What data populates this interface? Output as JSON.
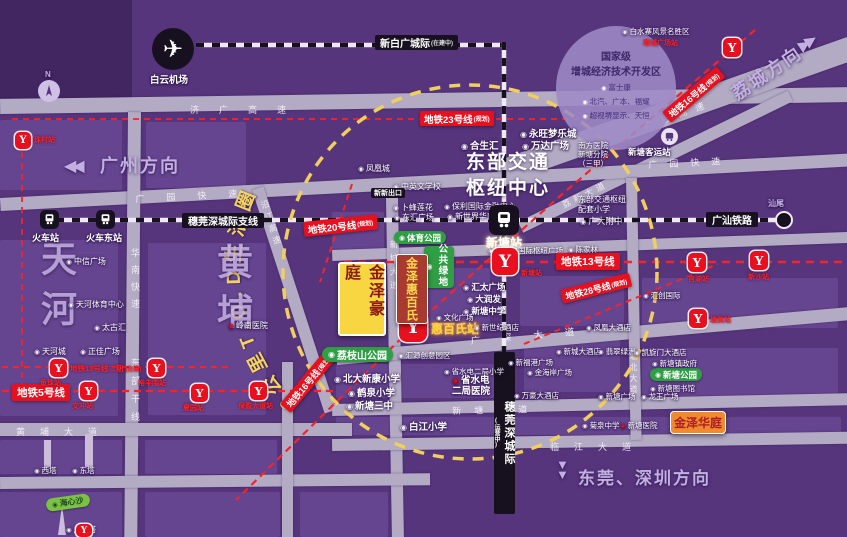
{
  "map_title": "金泽豪庭区位图",
  "circle_text": "3公里T.O.D生活圈",
  "directions": {
    "guangzhou": "广州方向",
    "licheng": "荔城方向",
    "dongguan_shenzhen": "东莞、深圳方向",
    "shanwei": "汕尾",
    "compass_n": "N"
  },
  "districts": {
    "tianhe": "天河",
    "huangpu": "黄埔"
  },
  "hub_title": "东部交通枢纽中心",
  "airport": "白云机场",
  "rails": {
    "xinbaiguang": {
      "t": "新白广城际",
      "s": "(在建中)"
    },
    "suiwanshen_branch": "穗莞深城际支线",
    "suiwanshen": {
      "t": "穗莞深城际",
      "s": "(运营中)"
    },
    "guangshan": "广汕铁路"
  },
  "train_stations": {
    "huochezhan": "火车站",
    "huochedongzhan": "火车东站",
    "xintangzhan": "新塘站",
    "keyunzhan": "新塘客运站"
  },
  "metro_lines": {
    "m5": {
      "t": "地铁5号线"
    },
    "m13": {
      "t": "地铁13号线"
    },
    "m13b": {
      "t": "地铁13号线二期",
      "s": "(在建)"
    },
    "m16": {
      "t": "地铁16号线",
      "s": "(规划)"
    },
    "m20": {
      "t": "地铁20号线",
      "s": "(规划)"
    },
    "m23": {
      "t": "地铁23号线",
      "s": "(规划)"
    },
    "m28": {
      "t": "地铁28号线",
      "s": "(规划)"
    }
  },
  "metro_stations": {
    "zhucun": "珠村站",
    "yuzhu": "鱼珠站",
    "yufengwei": "裕丰围站",
    "wenchong": "文冲站",
    "xiayuan": "夏园站",
    "baoying": "保盈大道站",
    "xintang": "新塘站",
    "guanhu": "官湖站",
    "xinsha": "新沙站",
    "tangmei": "塘美站",
    "zengchengguangchang": "增城广场站",
    "huibaishi": "惠百氏站"
  },
  "zone": {
    "t1": "国家级",
    "t2": "增城经济技术开发区",
    "items": [
      "富士康",
      "北汽、广本、福耀",
      "超视堺显示、天恒"
    ]
  },
  "projects": {
    "haoting": "金泽豪庭",
    "huibaishi": "金泽惠百氏",
    "huating": "金泽华庭"
  },
  "parks": {
    "tiyu": "体育公园",
    "lvdi": "公共绿地",
    "lizhishan": "荔枝山公园",
    "xintang": "新塘公园",
    "haixinsha": "海心沙"
  },
  "pois": {
    "zhongxin": "中信广场",
    "tianhetiyu": "天河体育中心",
    "taiguhui": "太古汇",
    "tianhecheng": "天河城",
    "zhengjia": "正佳广场",
    "lingnan": "岭南医院",
    "fenghuangcheng": "凤凰城",
    "zhongyingwen": "中英文学校",
    "bufeng": "卜蜂莲花",
    "donghui": "东汇广场",
    "baoli": "保利国际金融中心",
    "xinshijie": "新世界华南总部",
    "kaidaer": "凯达尔国际枢纽广场",
    "baishuizhai": "白水寨风景名胜区",
    "heshenghui": "合生汇",
    "yongwang": "永旺梦乐城",
    "wanda": "万达广场",
    "nanfang": "南方医院新塘分院（三甲）",
    "peitaoxiaoxue": "东部交通枢纽配套小学",
    "guangda": "广大附中",
    "chenjialin": "陈家林",
    "huitai": "汇太广场",
    "darunfa": "大润发",
    "xintangzhongxue": "新塘中学",
    "wenhua": "文化广场",
    "xinshiji": "新世纪酒店",
    "huichuang": "汇创国际",
    "fenghuanghotel": "凤凰大酒店",
    "feicui": "翡翠绿洲",
    "xinchenghotel": "新城大酒店",
    "kaixuanmen": "凯旋门大酒店",
    "xinfugang": "新福港广场",
    "jinhaian": "金海岸广场",
    "wanhao": "万豪大酒店",
    "shuidianxiaoxue": "省水电二局小学",
    "shuidianyiyuan": "省水电二局医院",
    "beida": "北大新康小学",
    "hequan": "鹤泉小学",
    "santhong": "新塘三中",
    "baijiang": "白江小学",
    "huiyuan": "汇源创意园区",
    "zhengfu": "新塘镇政府",
    "tushuguan": "新塘图书馆",
    "xtguangchang": "新塘广场",
    "longwang": "龙王广场",
    "juquan": "菊泉中学",
    "xtyiyuan": "新塘医院",
    "xita": "西塔",
    "dongta": "东塔",
    "gzta": "广州塔",
    "xinxinchukou": "新新出口"
  },
  "roads": {
    "jiguang": "济广高速",
    "guanghui": "广惠高速",
    "guangyuan": "广园快速",
    "huanan": "华南快速",
    "dongbu": "东部干线",
    "yanjiang": "沿江高速",
    "xincheng": "新城大道",
    "lixin": "荔新大道",
    "huangpu": "黄埔大道",
    "xintang": "新塘大道",
    "linjiang": "临江大道",
    "guangshen": "广深大道",
    "tangbei": "塘北大道"
  },
  "colors": {
    "background_purple": "#56357c",
    "road_gray": "#b3aac4",
    "metro_red": "#e8101f",
    "circle_yellow": "#f0cf5c",
    "project_yellow": "#f8d642",
    "project_brick": "#a93a30",
    "project_orange": "#f08a2e",
    "park_green": "#2f9e44",
    "rail_black": "#17111f"
  }
}
